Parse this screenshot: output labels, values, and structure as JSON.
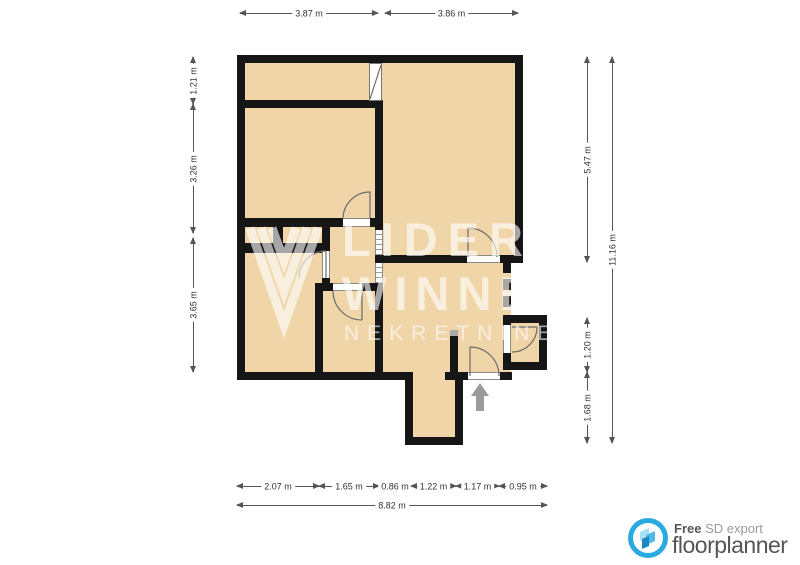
{
  "colors": {
    "floor": "#F0D5A9",
    "wall": "#161616",
    "gray_wall": "#A9A9A9",
    "dimension": "#555555",
    "brand_blue": "#29ABE2",
    "footer_text": "#555555"
  },
  "watermark": {
    "line1": "LIDER",
    "line2": "WINNE",
    "line3": "NEKRETNINE"
  },
  "entry": {
    "indicator": "up-arrow"
  },
  "dimensions": {
    "top": [
      {
        "label": "3.87 m",
        "x1": 240,
        "x2": 378,
        "y": 13
      },
      {
        "label": "3.86 m",
        "x1": 385,
        "x2": 518,
        "y": 13
      }
    ],
    "bottom": [
      {
        "label": "2.07 m",
        "x1": 237,
        "x2": 319,
        "y": 486
      },
      {
        "label": "1.65 m",
        "x1": 319,
        "x2": 379,
        "y": 486
      },
      {
        "label": "0.86 m",
        "x1": 379,
        "x2": 411,
        "y": 486
      },
      {
        "label": "1.22 m",
        "x1": 411,
        "x2": 456,
        "y": 486
      },
      {
        "label": "1.17 m",
        "x1": 456,
        "x2": 499,
        "y": 486
      },
      {
        "label": "0.95 m",
        "x1": 499,
        "x2": 547,
        "y": 486
      },
      {
        "label": "8.82 m",
        "x1": 237,
        "x2": 547,
        "y": 505
      }
    ],
    "left": [
      {
        "label": "1.21 m",
        "y1": 57,
        "y2": 104,
        "x": 193
      },
      {
        "label": "3.26 m",
        "y1": 104,
        "y2": 233,
        "x": 193
      },
      {
        "label": "3.65 m",
        "y1": 238,
        "y2": 372,
        "x": 193
      }
    ],
    "right": [
      {
        "label": "5.47 m",
        "y1": 57,
        "y2": 262,
        "x": 587
      },
      {
        "label": "1.20 m",
        "y1": 318,
        "y2": 372,
        "x": 587
      },
      {
        "label": "1.68 m",
        "y1": 372,
        "y2": 443,
        "x": 587
      },
      {
        "label": "11.16 m",
        "y1": 57,
        "y2": 443,
        "x": 612
      }
    ]
  },
  "footer": {
    "free_label": "Free",
    "export_label": "SD export",
    "brand": "floorplanner"
  }
}
